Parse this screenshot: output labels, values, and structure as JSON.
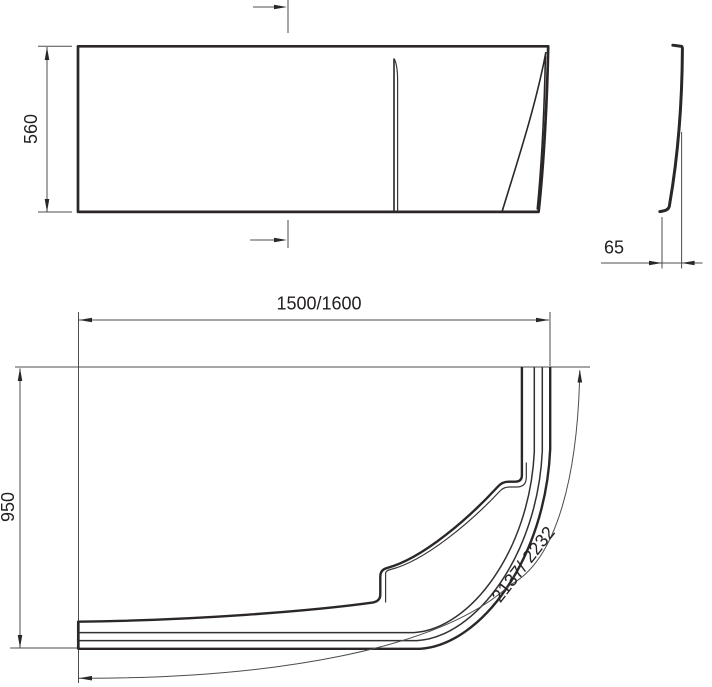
{
  "drawing": {
    "type": "technical-dimension-drawing",
    "views": {
      "front": {
        "height": "560"
      },
      "side": {
        "thickness": "65"
      },
      "plan": {
        "width": "1500/1600",
        "depth": "950",
        "arc_length": "2137/ 2232"
      }
    }
  },
  "colors": {
    "line": "#2b2728",
    "thin_line": "#4c4c4c",
    "background": "#ffffff"
  }
}
